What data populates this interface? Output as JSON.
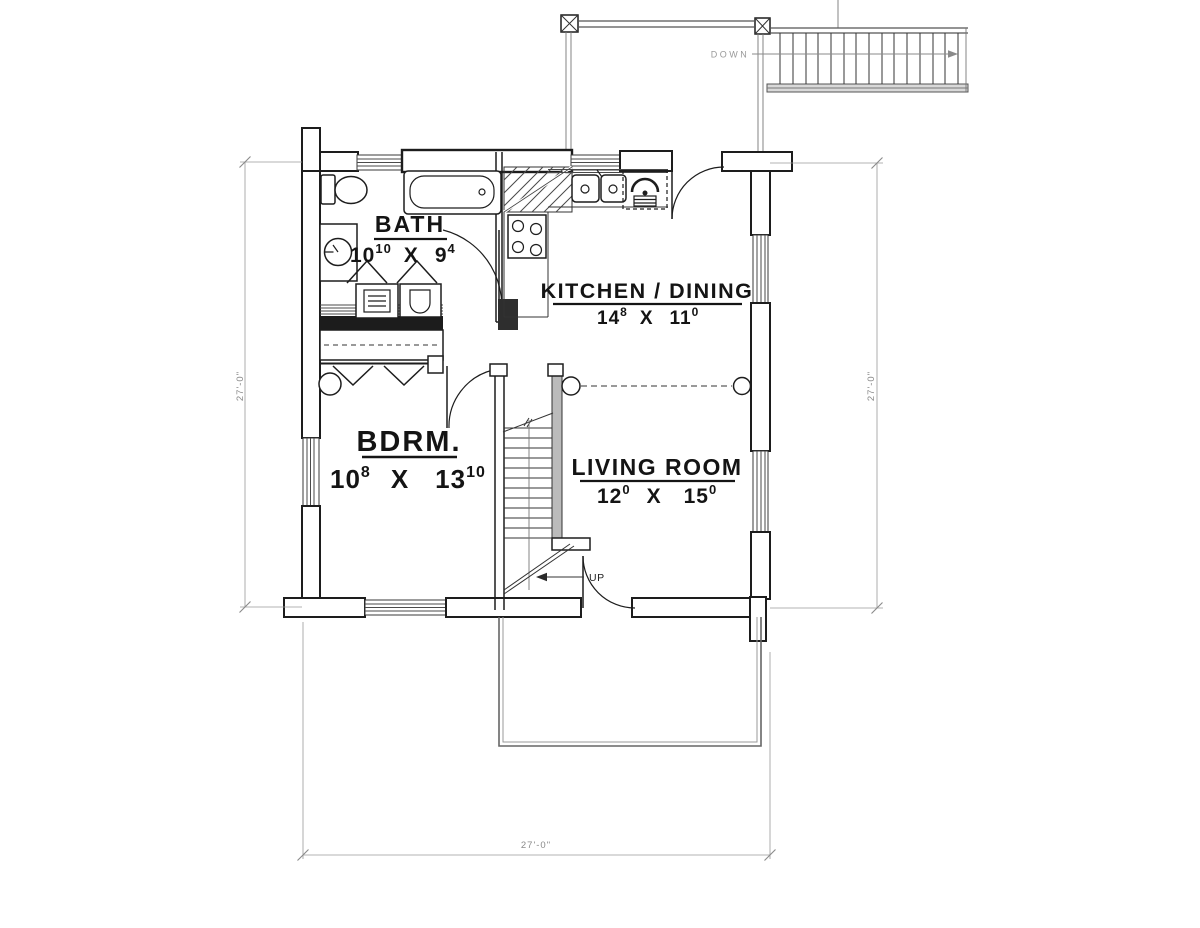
{
  "plan": {
    "rooms": {
      "bath": {
        "name": "BATH",
        "w": "10",
        "w_sup": "10",
        "sep": "X",
        "h": "9",
        "h_sup": "4"
      },
      "kitchen_dining": {
        "name": "KITCHEN  /  DINING",
        "w": "14",
        "w_sup": "8",
        "sep": "X",
        "h": "11",
        "h_sup": "0"
      },
      "bedroom": {
        "name": "BDRM.",
        "w": "10",
        "w_sup": "8",
        "sep": "X",
        "h": "13",
        "h_sup": "10"
      },
      "living_room": {
        "name": "LIVING  ROOM",
        "w": "12",
        "w_sup": "0",
        "sep": "X",
        "h": "15",
        "h_sup": "0"
      }
    },
    "stairs": {
      "up_label": "UP",
      "down_label": "DOWN"
    },
    "dimensions": {
      "left": "27'-0\"",
      "right": "27'-0\"",
      "bottom": "27'-0\""
    },
    "fixtures": [
      "toilet",
      "bathtub",
      "vanity-sink",
      "washer",
      "dryer",
      "range",
      "kitchen-sink",
      "refrigerator",
      "closet-rod",
      "beam-posts"
    ],
    "colors": {
      "ink": "#1d1d1d",
      "muted": "#8a8a8a",
      "wall_dark": "#1c1c1c",
      "stair_wall": "#bbbbbb",
      "paper": "#ffffff"
    }
  }
}
